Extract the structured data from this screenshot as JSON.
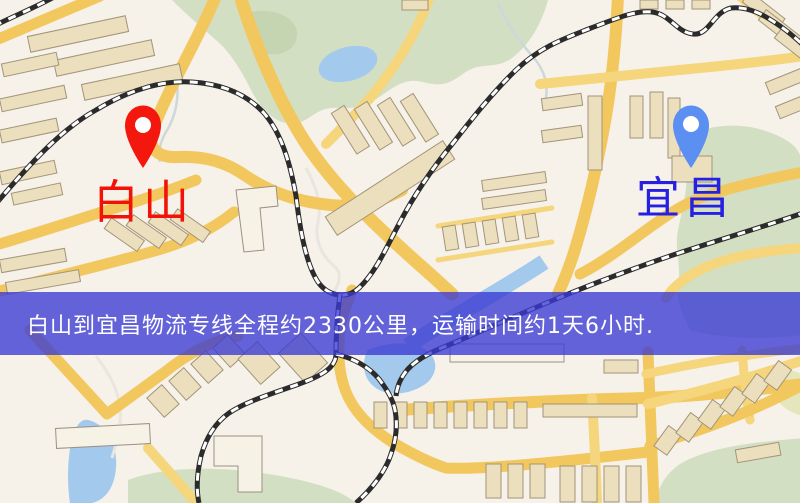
{
  "page": {
    "type": "logistics-route-map-image"
  },
  "banner": {
    "text": "白山到宜昌物流专线全程约2330公里，运输时间约1天6小时.",
    "bg_color": "#3a3ad4",
    "text_color": "#ffffff"
  },
  "origin": {
    "label": "白山",
    "label_color": "#f11307",
    "pin_color": "#f3170d"
  },
  "destination": {
    "label": "宜昌",
    "label_color": "#2621e2",
    "pin_color": "#5b8ff2"
  },
  "map_palette": {
    "background": "#f6f1e9",
    "road": "#f2c75e",
    "building": "#ebdfbd",
    "park": "#d3dfc3",
    "water": "#a3c9ec",
    "railway": "#2b2b2b"
  }
}
